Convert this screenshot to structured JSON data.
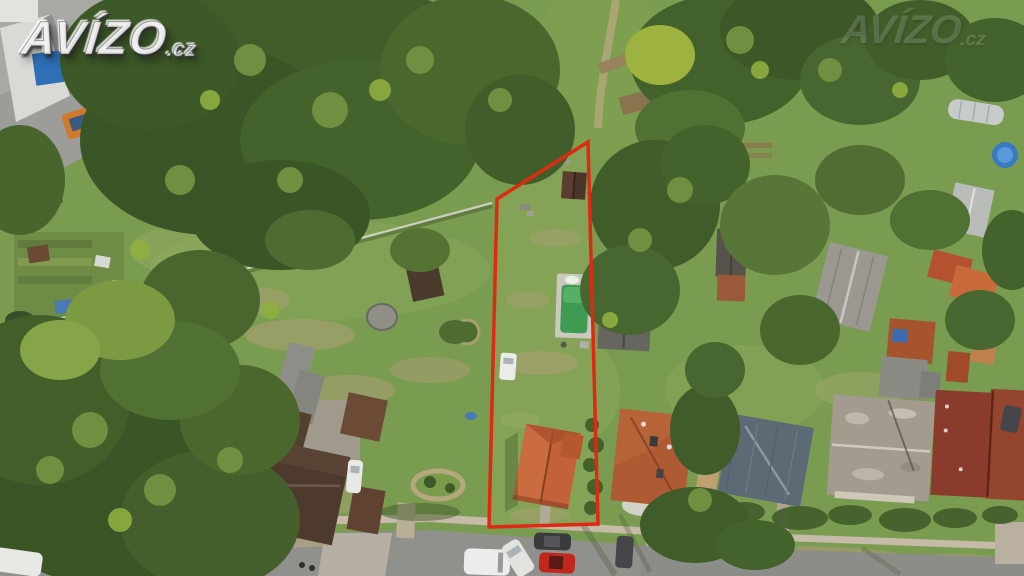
{
  "brand_watermark": {
    "text": "AVÍZO",
    "suffix": ".cz"
  },
  "corner_watermark": {
    "text": "AVÍZO",
    "suffix": ".cz"
  },
  "annotation": {
    "parcel_outline_color": "#e02912"
  },
  "palette": {
    "meadow": "#7a9c50",
    "parcel_lawn": "#85a356",
    "forest": "#3a5526",
    "pavement": "#9c9c98",
    "road": "#90908c",
    "sidewalk": "#c6baa8",
    "pool_water": "#3f9a52",
    "pool_deck": "#c9c9c0",
    "parcel_house_roof": "#c2613a",
    "farm_roof": "#4e3a2d",
    "right_house_roof": "#ae5b33",
    "metal_roof": "#5c6a76",
    "weathered_roof": "#a29b8e",
    "dark_red_roof": "#8a3b2b",
    "truck_orange": "#d07a2a",
    "container_blue": "#2f6fb5",
    "car_white": "#ececea",
    "car_red": "#c1271d",
    "car_dark": "#3b3b3e"
  }
}
